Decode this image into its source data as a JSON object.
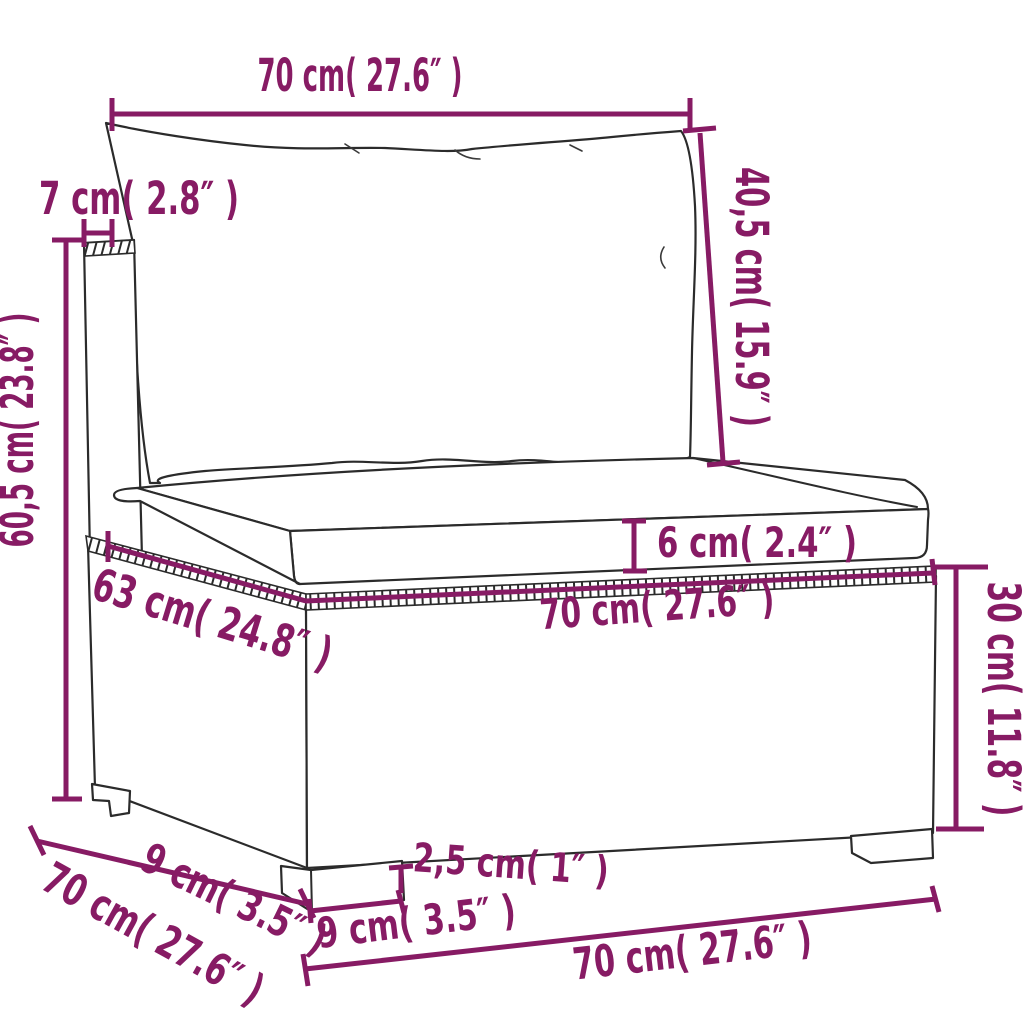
{
  "diagram": {
    "type": "furniture-dimension-diagram",
    "colors": {
      "dimension_annotation": "#871B64",
      "line_art": "#2b2b2b",
      "background": "#ffffff"
    },
    "labels": {
      "top_width": "70 cm( 27.6″ )",
      "backrest_thickness": "7 cm( 2.8″ )",
      "total_height": "60,5 cm( 23.8″ )",
      "backrest_height": "40,5 cm( 15.9″ )",
      "seat_cushion_thickness": "6 cm( 2.4″ )",
      "seat_depth": "63 cm( 24.8″ )",
      "seat_width": "70 cm( 27.6″ )",
      "base_height": "30 cm( 11.8″ )",
      "ground_clearance": "2,5 cm( 1″ )",
      "leg_width": "9 cm( 3.5″ )",
      "base_width": "70 cm( 27.6″ )",
      "leg_depth": "9 cm( 3.5″ )",
      "total_depth": "70 cm( 27.6″ )"
    }
  }
}
